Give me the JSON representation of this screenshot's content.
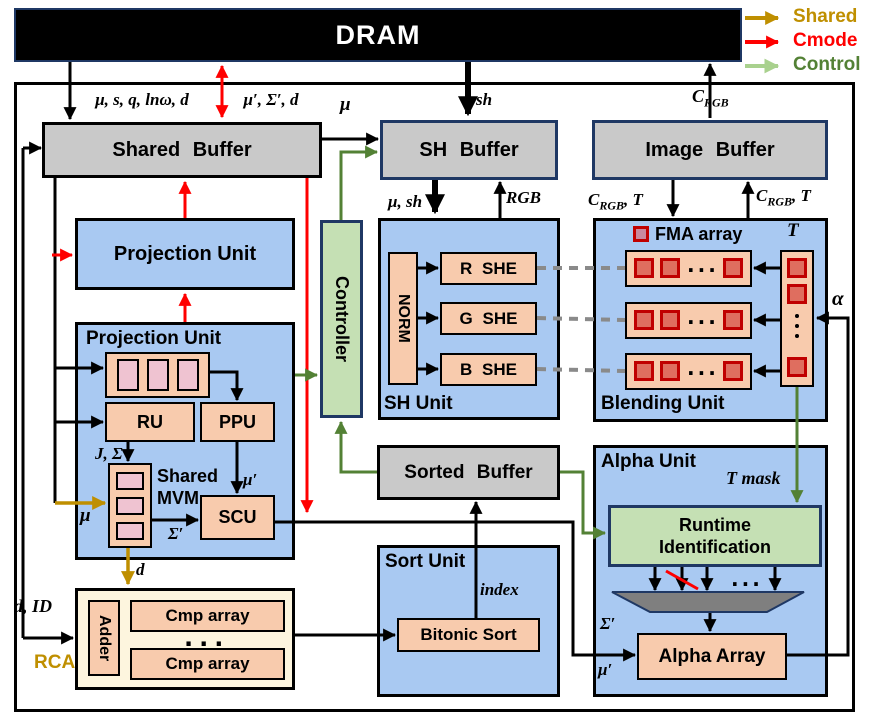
{
  "dram": {
    "title": "DRAM"
  },
  "legend": {
    "items": [
      {
        "label": "Shared",
        "color": "#BF8F00"
      },
      {
        "label": "Cmode",
        "color": "#FF0000"
      },
      {
        "label": "Control",
        "color": "#538135"
      }
    ]
  },
  "buffers": {
    "shared": "Shared Buffer",
    "sh": "SH Buffer",
    "image": "Image Buffer",
    "sorted": "Sorted Buffer"
  },
  "controller": {
    "label": "Controller"
  },
  "projection_top": {
    "title": "Projection Unit"
  },
  "projection": {
    "title": "Projection Unit",
    "ru": "RU",
    "ppu": "PPU",
    "scu": "SCU",
    "mvm_line1": "Shared",
    "mvm_line2": "MVM"
  },
  "rca": {
    "label": "RCA",
    "adder": "Adder",
    "cmp_top": "Cmp array",
    "cmp_bottom": "Cmp array",
    "dots": "···"
  },
  "sh_unit": {
    "title": "SH Unit",
    "norm": "NORM",
    "r_she": "R SHE",
    "g_she": "G SHE",
    "b_she": "B SHE"
  },
  "blending": {
    "title": "Blending Unit",
    "fma_legend": "FMA array",
    "t_label": "T",
    "row_dots": "···"
  },
  "sort": {
    "title": "Sort Unit",
    "bitonic": "Bitonic Sort"
  },
  "alpha_unit": {
    "title": "Alpha Unit",
    "runtime_line1": "Runtime",
    "runtime_line2": "Identification",
    "alpha_array": "Alpha Array",
    "dots": "···"
  },
  "signals": {
    "mu_s_q_lnw_d": "μ, s, q, lnω, d",
    "mu_sigma_d": "μ′, Σ′, d",
    "mu": "μ",
    "sh": "sh",
    "c_base": "C",
    "c_sub": "RGB",
    "t_suffix": ", T",
    "mu_sh": "μ, sh",
    "rgb": "RGB",
    "t": "T",
    "alpha": "α",
    "j_sigma": "J, Σ",
    "mu_prime": "μ′",
    "sigma_prime": "Σ′",
    "d": "d",
    "d_id": "d, ID",
    "index": "index",
    "t_mask": "T mask"
  },
  "colors": {
    "unit_fill": "#A9C9F2",
    "block_fill": "#F8CBAD",
    "buffer_fill": "#C9C9C9",
    "control_fill": "#C5E0B4",
    "rca_fill": "#FDF5DE",
    "pink_cell": "#EFC3D1",
    "fma_border": "#C00000",
    "fma_fill": "#DF6E5F",
    "fma_legend_fill": "#C9899E",
    "shared_arrow": "#BF8F00",
    "cmode_arrow": "#FF0000",
    "control_arrow": "#538135",
    "control_legend_arrow": "#A9D18E",
    "navy_border": "#1F3864"
  }
}
